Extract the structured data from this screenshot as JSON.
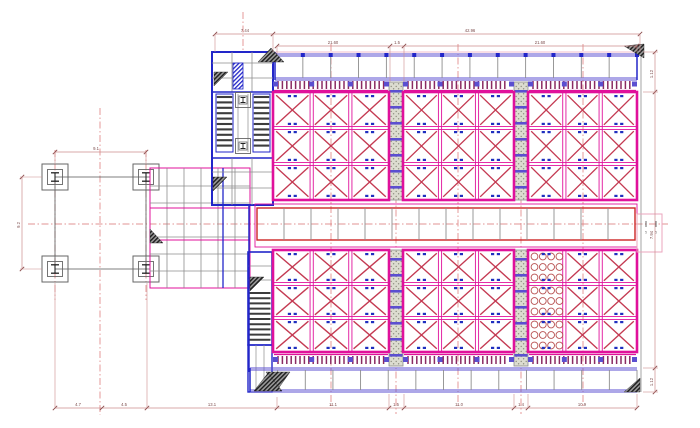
{
  "drawing": {
    "canvas": {
      "width": 700,
      "height": 428,
      "background": "#ffffff"
    },
    "colors": {
      "magenta": "#e0119b",
      "crimson": "#c43a52",
      "red": "#cc2525",
      "blue": "#2226c9",
      "purple": "#5b4fd0",
      "pin": "#8b2a62",
      "gray": "#8d8d8d",
      "frame": "#555555",
      "tread": "#3c3c3c",
      "dim": "#cc8d8d",
      "dim_slash": "#8a4b4b",
      "dim_text": "#7a4a4a",
      "centerline": "#d97070",
      "pink_light": "#eba6be",
      "tag": "#1f2fbf",
      "circle_hatch": "#b85252",
      "stipple_bg": "#dcdcd0",
      "stipple_dot": "#8a8a7c",
      "hatch_dark": "#1c1c1c",
      "hatch_mid": "#9a9a9a"
    },
    "components": {
      "braced_blocks": 6,
      "cells_per_block": 9,
      "bracing": "X",
      "foundation_footings": 4,
      "stair_flights": 3,
      "hatched_strips": 4,
      "grating_panel_cells": 3
    },
    "dimensions": {
      "top_outer": {
        "y": 34,
        "ticks": [
          215,
          273,
          640
        ],
        "labels": [
          {
            "text": "7.44",
            "x": 245
          },
          {
            "text": "42.96",
            "x": 470
          }
        ]
      },
      "top_inner": {
        "y": 46,
        "ticks": [
          277,
          390,
          404,
          637
        ],
        "labels": [
          {
            "text": "21.60",
            "x": 333
          },
          {
            "text": "1.5",
            "x": 397
          },
          {
            "text": "21.60",
            "x": 540
          }
        ]
      },
      "bottom": {
        "y": 408,
        "ticks": [
          55,
          102,
          147,
          277,
          389,
          404,
          514,
          528,
          637
        ],
        "labels": [
          {
            "text": "4.7",
            "x": 78
          },
          {
            "text": "4.5",
            "x": 124
          },
          {
            "text": "13.1",
            "x": 212
          },
          {
            "text": "11.1",
            "x": 333
          },
          {
            "text": "1.5",
            "x": 396
          },
          {
            "text": "11.0",
            "x": 459
          },
          {
            "text": "1.4",
            "x": 521
          },
          {
            "text": "10.9",
            "x": 582
          }
        ]
      },
      "right": {
        "x": 655,
        "ticks": [
          52,
          92,
          368,
          392
        ],
        "labels": [
          {
            "text": "1.12",
            "y": 74
          },
          {
            "text": "7.94",
            "y": 235
          },
          {
            "text": "1.12",
            "y": 382
          }
        ]
      },
      "left": {
        "x": 22,
        "ticks": [
          177,
          269
        ],
        "labels": [
          {
            "text": "9.2",
            "y": 225
          }
        ]
      },
      "foundation_top": {
        "y": 152,
        "ticks": [
          55,
          146
        ],
        "labels": [
          {
            "text": "9.1",
            "x": 96
          }
        ]
      },
      "corridor_end": {
        "y": 233.5,
        "labels": [
          {
            "text": "5",
            "x": 646
          },
          {
            "text": "5",
            "x": 656
          }
        ]
      }
    }
  }
}
